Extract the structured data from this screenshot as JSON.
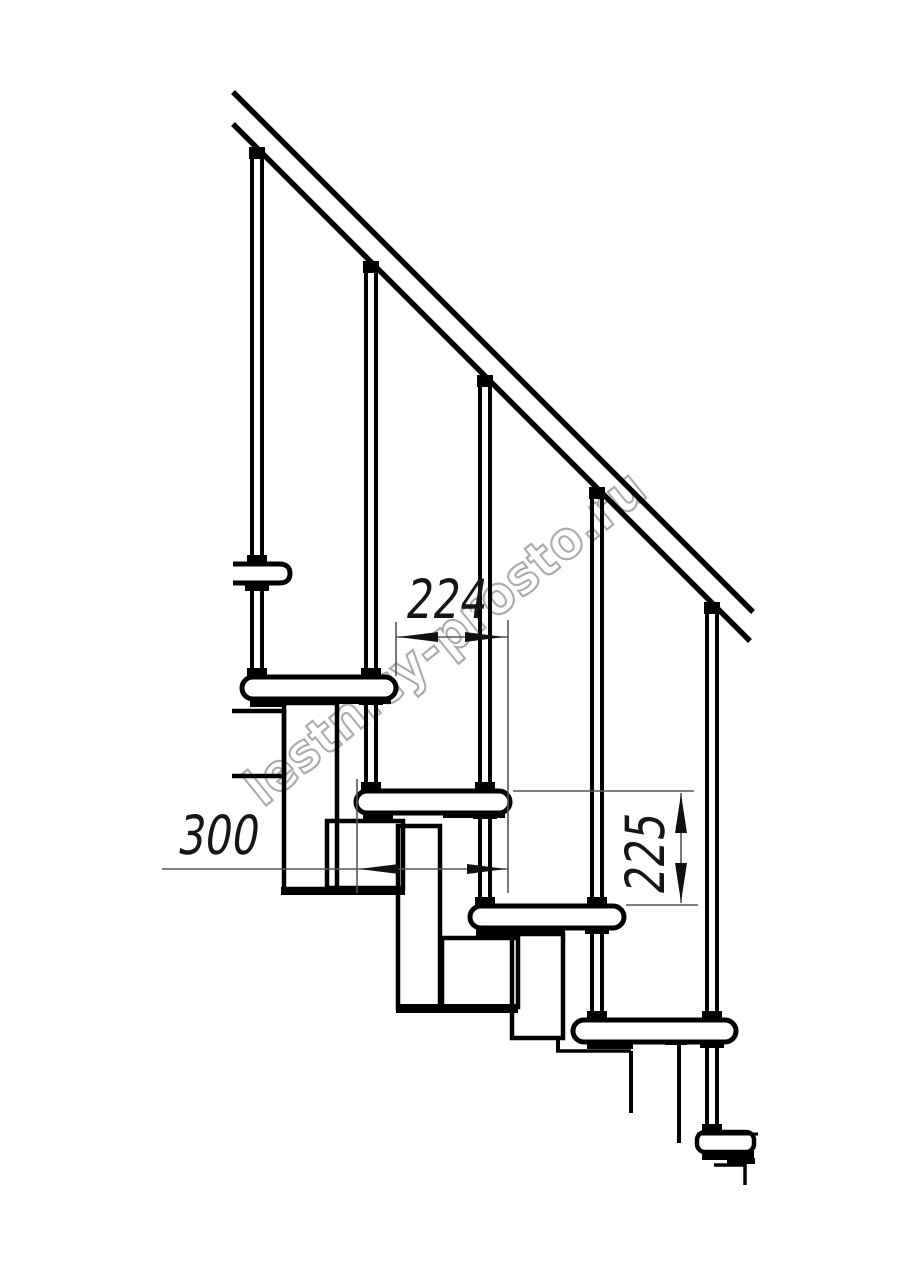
{
  "watermark": {
    "text": "lestnicy-prosto.ru"
  },
  "dimensions": {
    "step_run": "224",
    "tread_depth": "300",
    "riser_height": "225"
  },
  "structure": {
    "treads": 5,
    "balusters": 5,
    "handrail": true
  },
  "colors": {
    "line": "#000000",
    "dim_line": "#565656",
    "dim_text": "#161616",
    "watermark": "#ababab",
    "background": "#ffffff"
  }
}
